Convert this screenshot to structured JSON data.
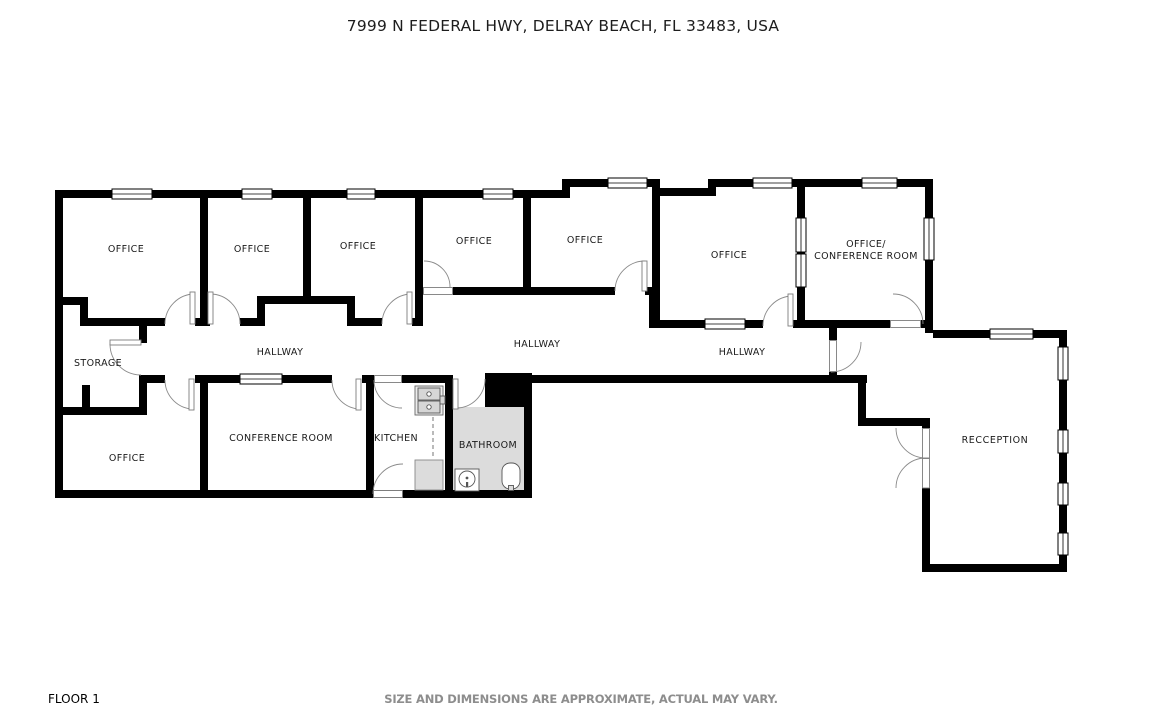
{
  "title": "7999 N FEDERAL HWY, DELRAY BEACH, FL 33483, USA",
  "footer": {
    "floor_label": "FLOOR 1",
    "disclaimer": "SIZE AND DIMENSIONS ARE APPROXIMATE, ACTUAL MAY VARY."
  },
  "colors": {
    "wall": "#000000",
    "bathroom_fill": "#dcdcdc",
    "counter_fill": "#dcdcdc",
    "door_arc": "#8a8a8a",
    "label_text": "#1a1a1a",
    "disclaimer_text": "#8d8d8d"
  },
  "floor_plan": {
    "rooms": {
      "office_1": "OFFICE",
      "office_2": "OFFICE",
      "office_3": "OFFICE",
      "office_4": "OFFICE",
      "office_5": "OFFICE",
      "office_6": "OFFICE",
      "office_conference_line_1": "OFFICE/",
      "office_conference_line_2": "CONFERENCE ROOM",
      "storage": "STORAGE",
      "hallway_west": "HALLWAY",
      "hallway_center": "HALLWAY",
      "hallway_east": "HALLWAY",
      "office_lower_left": "OFFICE",
      "conference_room": "CONFERENCE ROOM",
      "kitchen": "KITCHEN",
      "bathroom": "BATHROOM",
      "reception": "RECCEPTION"
    }
  }
}
